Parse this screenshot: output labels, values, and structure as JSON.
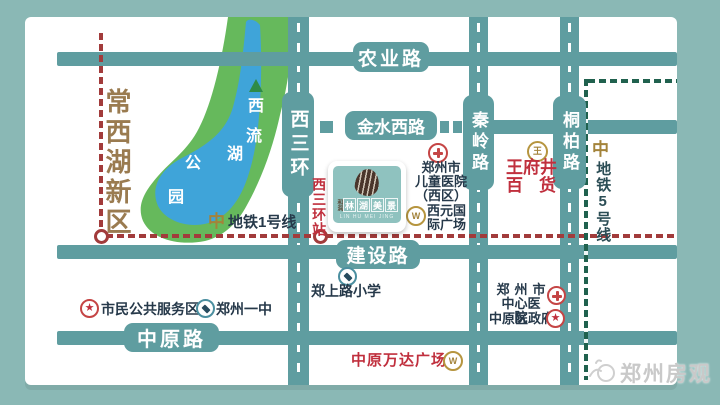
{
  "colors": {
    "background": "#8ab8b5",
    "road": "#5f9da0",
    "park_green": "#66b95c",
    "lake_blue": "#3fa4d9",
    "metro1_red": "#a23b3b",
    "metro5_green": "#20614e",
    "accent_red": "#c02f3d",
    "gold": "#a3833a",
    "text_dark": "#26394a",
    "district_brown": "#9a7b50"
  },
  "district": {
    "label": "常西湖新区"
  },
  "park": {
    "lake_chars": [
      "西",
      "流",
      "湖"
    ],
    "park_chars": [
      "公",
      "园"
    ]
  },
  "roads": {
    "nongye": "农业路",
    "jinshui": "金水西路",
    "jianshe": "建设路",
    "zhongyuan": "中原路",
    "sanhuan": "西三环",
    "qinling": "秦岭路",
    "tongbai": "桐柏路"
  },
  "metro": {
    "line1": {
      "label": "地铁1号线",
      "station": "西三环站"
    },
    "line5": {
      "label": "地铁5号线"
    }
  },
  "logo": {
    "prefix": "和润",
    "name_chars": [
      "林",
      "湖",
      "美",
      "景"
    ],
    "latin": "LIN HU MEI JING"
  },
  "pois": {
    "children_hospital": {
      "line1": "郑州市",
      "line2": "儿童医院",
      "line3": "（西区）"
    },
    "xiyuan_plaza": {
      "line1": "西元国",
      "line2": "际广场"
    },
    "wangfujing": {
      "line1": "王府井",
      "line2": "百货"
    },
    "zhengshang_school": {
      "label": "郑上路小学"
    },
    "civic_center": {
      "label": "市民公共服务区"
    },
    "no1_middle_school": {
      "label": "郑州一中"
    },
    "central_hospital": {
      "line1": "郑州市",
      "line2": "中心医院"
    },
    "district_gov": {
      "label": "中原区政府"
    },
    "wanda_plaza": {
      "label": "中原万达广场"
    }
  },
  "icons": {
    "star": "★",
    "metro_logo": "中",
    "gold_w": "W",
    "gold_wang": "王"
  },
  "watermark": {
    "label": "郑州房观"
  }
}
